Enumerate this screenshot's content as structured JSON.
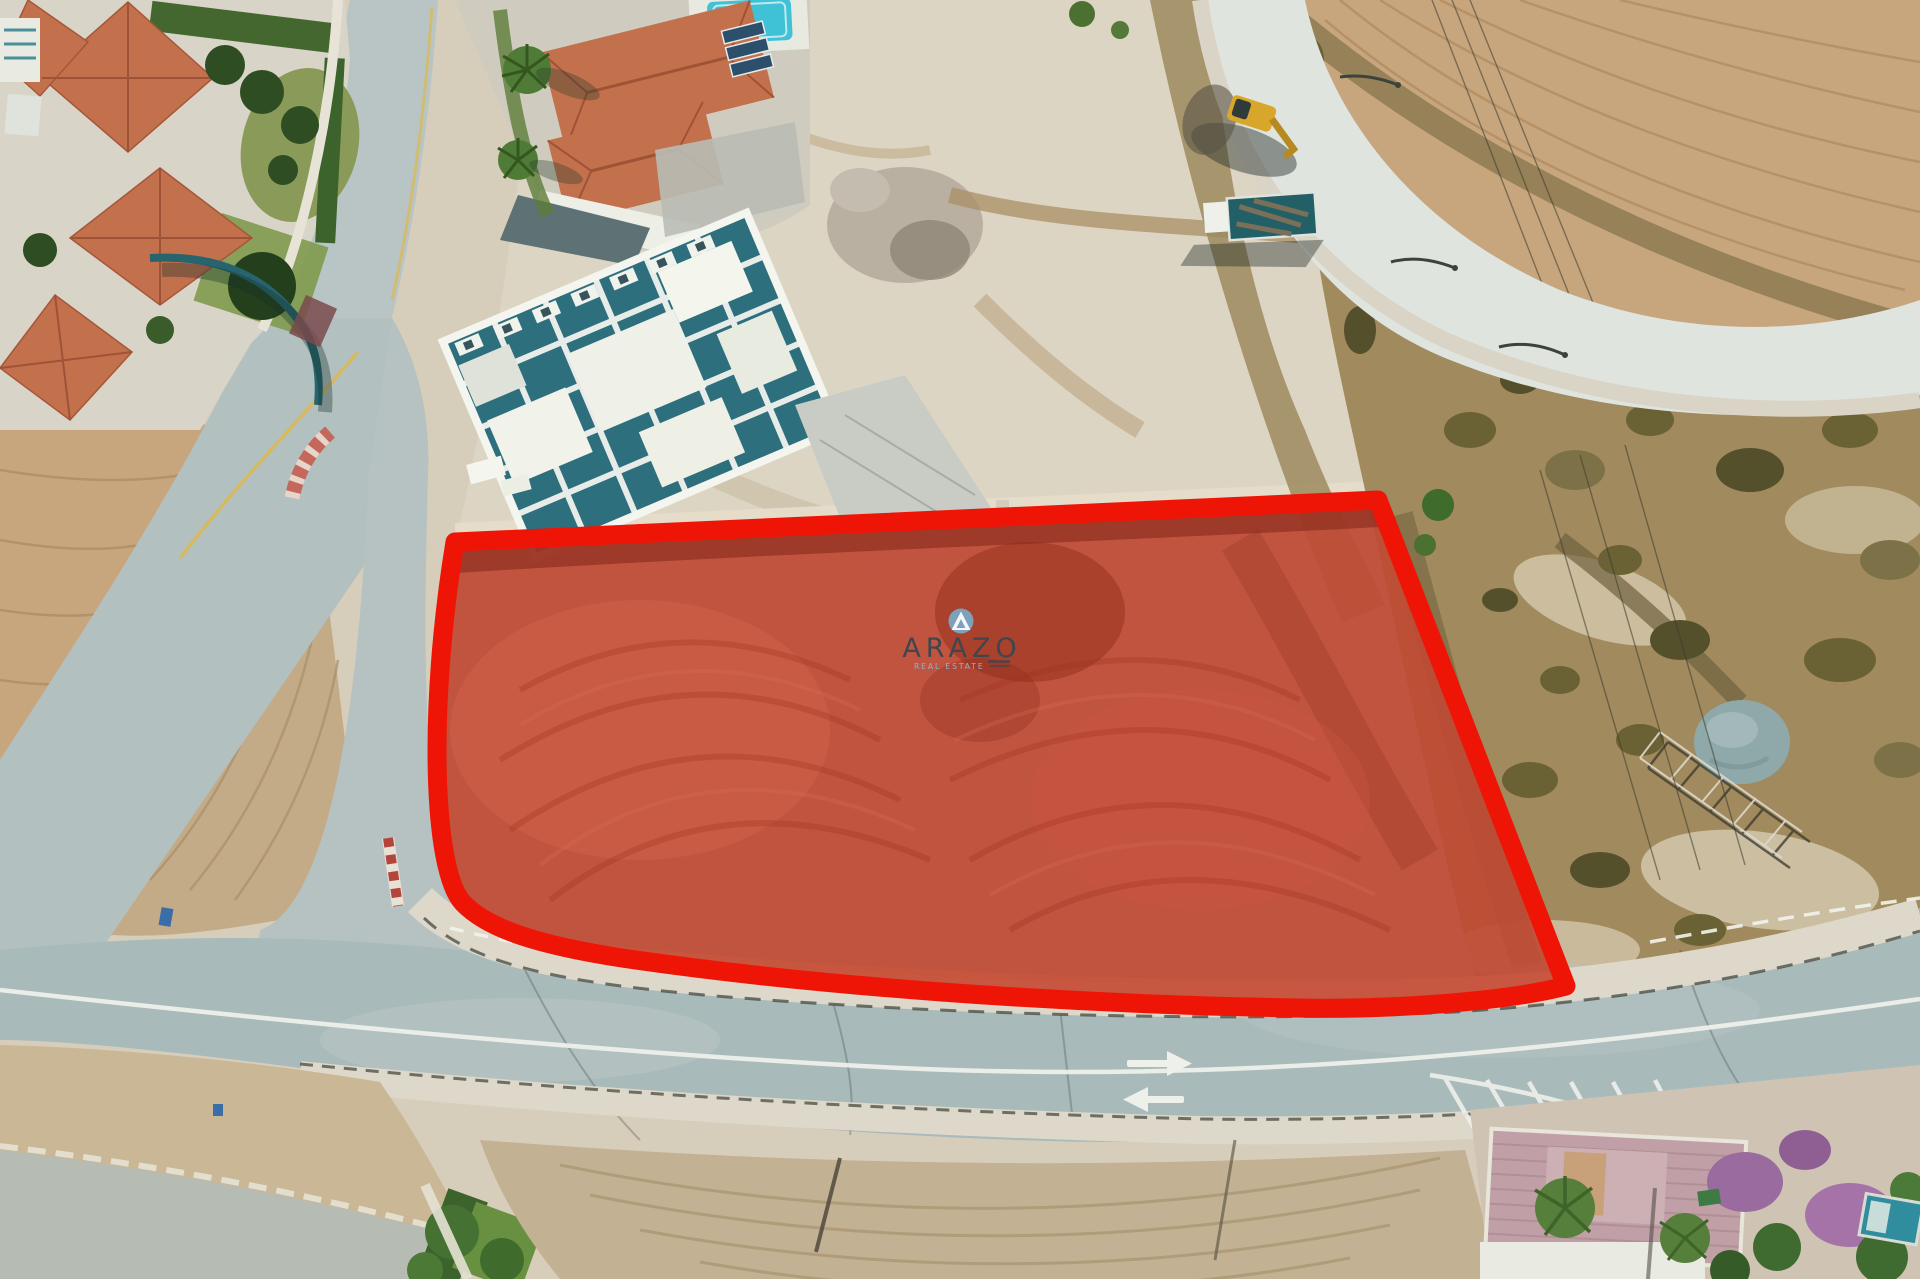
{
  "watermark": {
    "brand": "ARAZO",
    "tagline": "REAL ESTATE",
    "badge_color": "#7ba7c3",
    "badge_icon": "triangle-a-icon",
    "wordmark_color": "#3f464e",
    "tagline_color": "#8fb3cc",
    "underline_color": "#3f464e"
  },
  "plot_overlay": {
    "fill_color": "#bf4a34",
    "border_color": "#ee1506",
    "border_width": "19"
  },
  "palette": {
    "sand": "#d6cdba",
    "dirt_light": "#ddd5c3",
    "field_tan": "#c7a67e",
    "furrow_brown": "#b28a5f",
    "scrub_olive": "#a18a5d",
    "bush_dark": "#6a6134",
    "asphalt": "#a9babb",
    "asphalt_light": "#b9c5c4",
    "concrete_road": "#e0e4df",
    "sidewalk": "#ddd8ca",
    "curb_dark": "#3f4238",
    "roof_terracotta": "#c3714d",
    "roof_ridge": "#9e5236",
    "teal_wall": "#27646e",
    "construction_teal": "#2e6f7e",
    "white_wall": "#f1f2ea",
    "lawn_green": "#6f9344",
    "tree_green": "#2e4d22",
    "palm_green": "#4e7c36",
    "purple_bloom": "#9a6b9e",
    "mauve_terrace": "#c0a0a6",
    "pool_turquoise": "#3fc1d6",
    "pond_gray": "#8fa9ab",
    "excavator_yellow": "#d9a62c",
    "truck_teal": "#235f66",
    "marking_white": "#eef0ea",
    "yellow_curb": "#d9b856"
  }
}
